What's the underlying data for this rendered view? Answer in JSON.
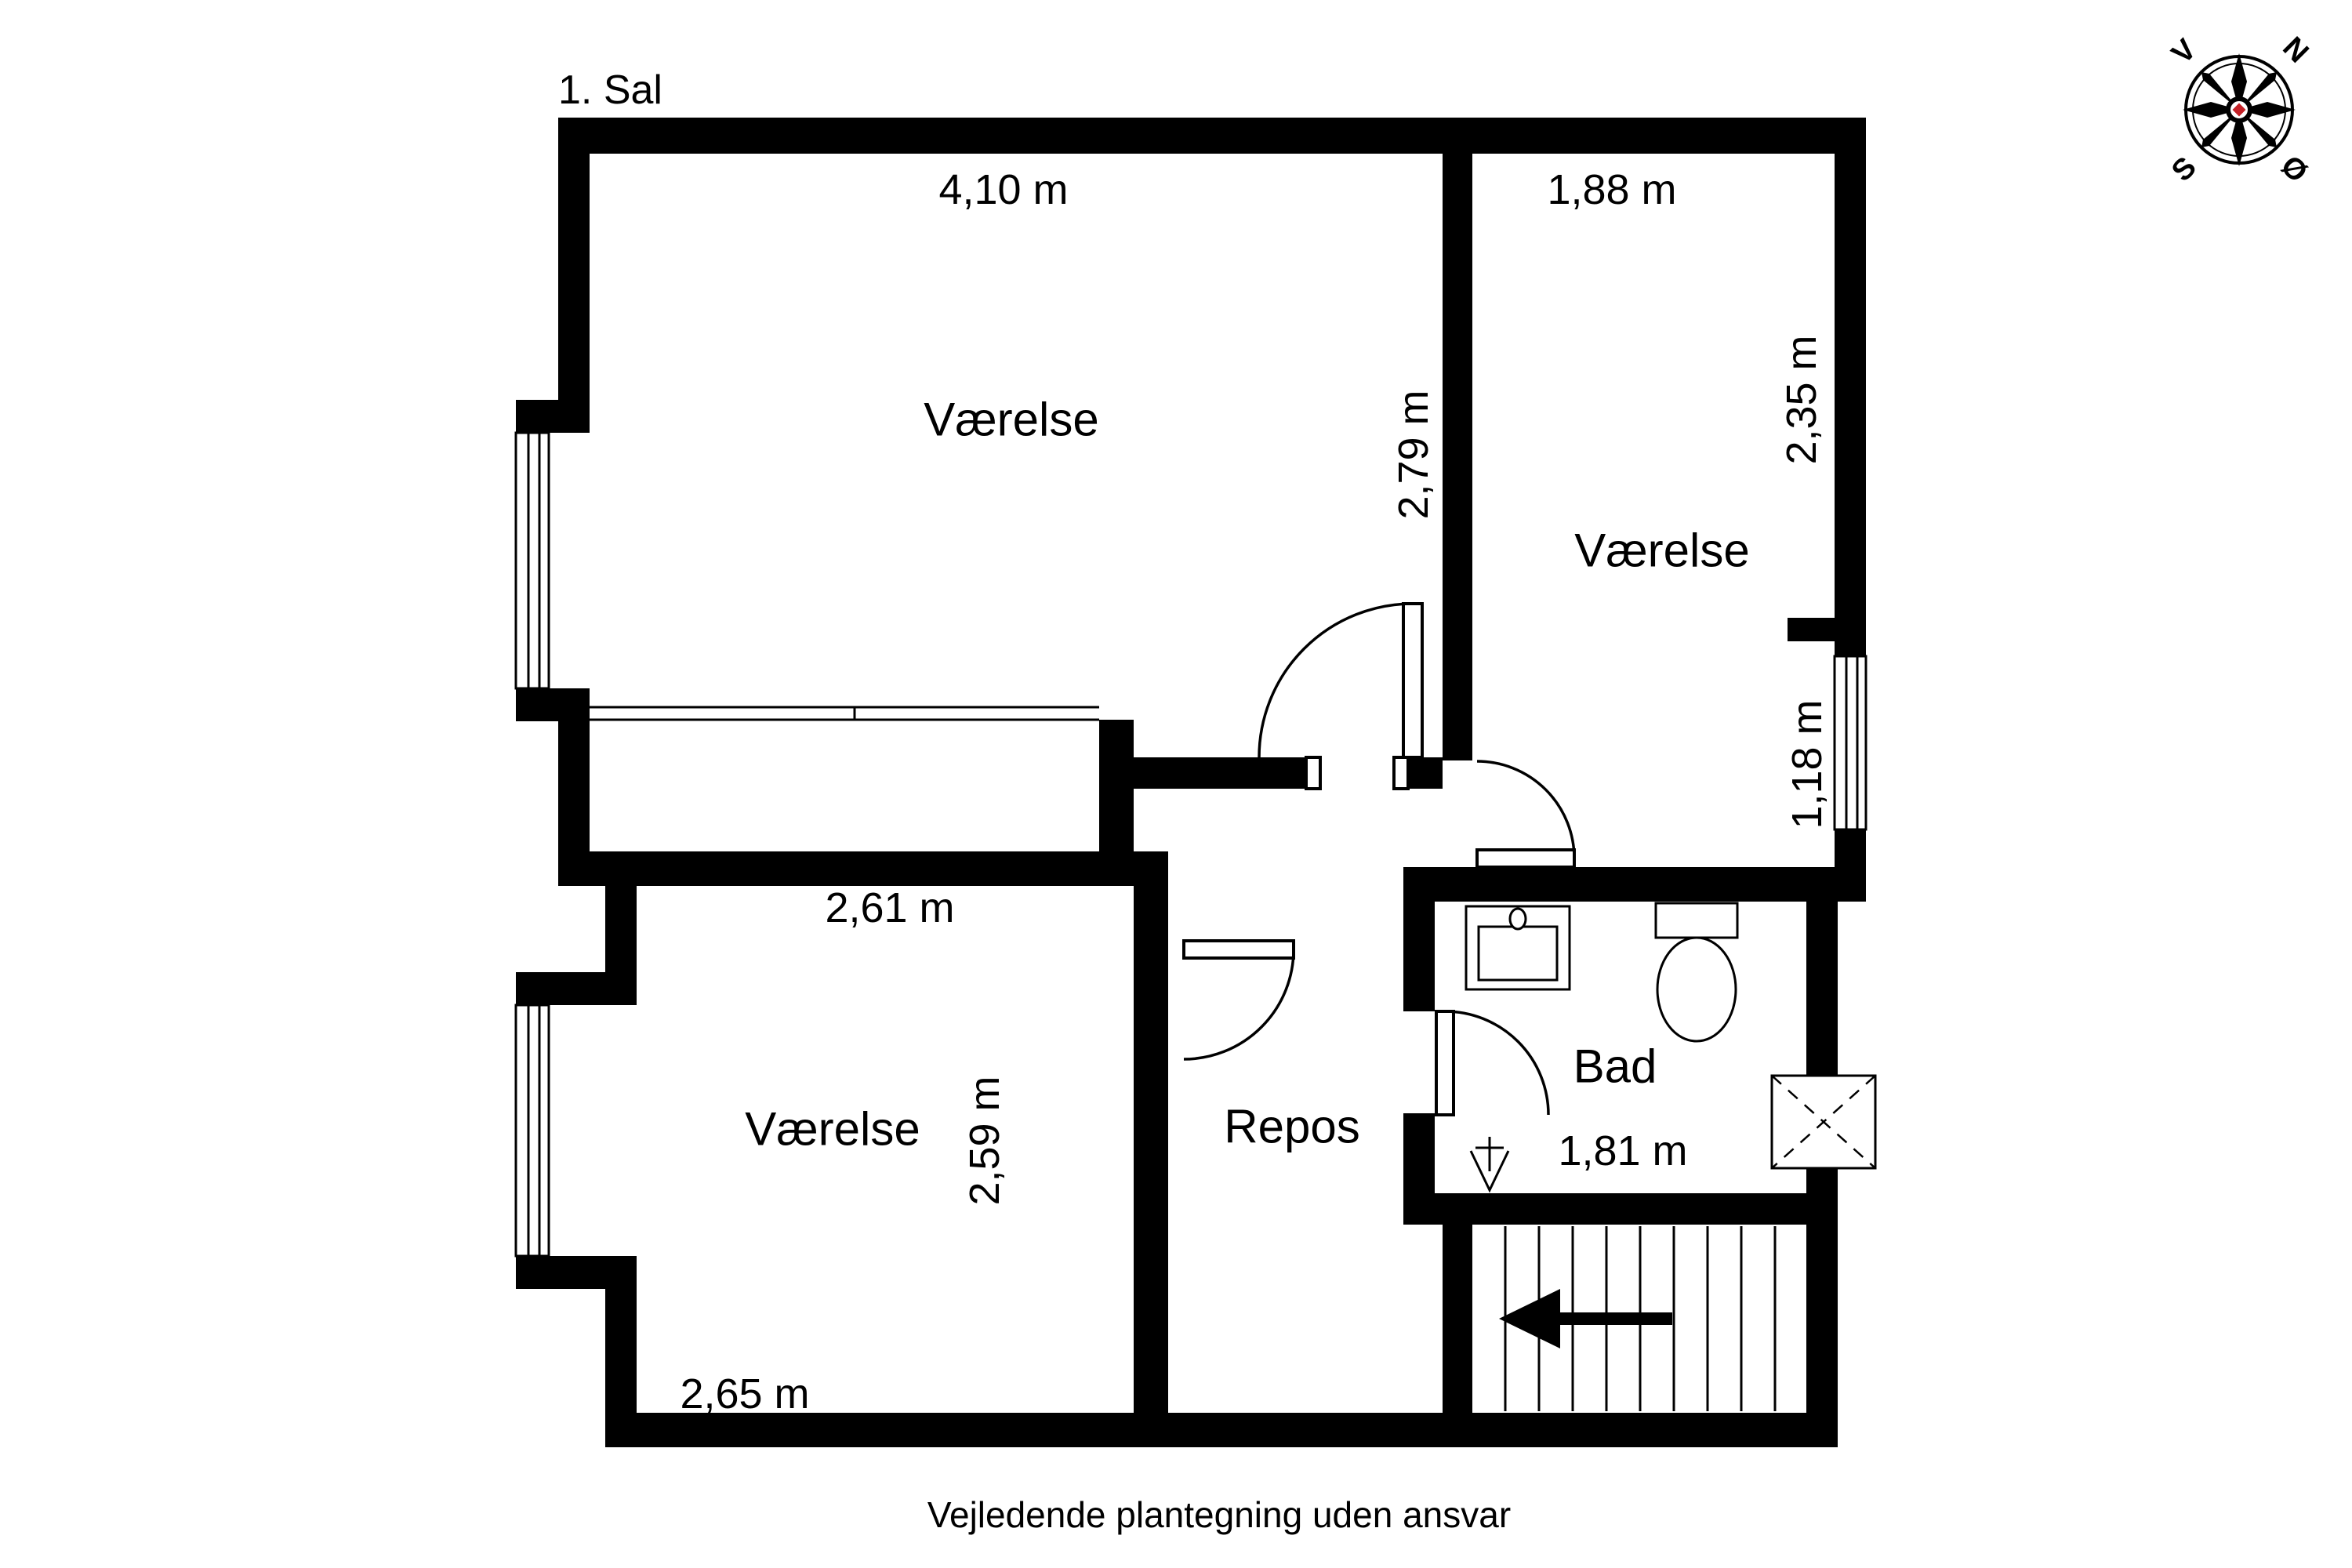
{
  "title": "1. Sal",
  "footer": "Vejledende plantegning uden ansvar",
  "compass": {
    "north": "N",
    "south": "S",
    "east": "Ø",
    "west": "V"
  },
  "rooms": {
    "top_left": "Værelse",
    "top_right": "Værelse",
    "bottom_left": "Værelse",
    "landing": "Repos",
    "bathroom": "Bad"
  },
  "dimensions": {
    "top_left_width": "4,10 m",
    "top_left_depth": "2,79 m",
    "top_right_width": "1,88 m",
    "top_right_depth": "2,35 m",
    "hall_window": "1,18 m",
    "bottom_left_width_top": "2,61 m",
    "bottom_left_depth": "2,59 m",
    "bottom_left_width_bottom": "2,65 m",
    "stairs_width": "1,81 m"
  },
  "colors": {
    "wall": "#000000",
    "background": "#ffffff",
    "compass_accent": "#c32026"
  }
}
